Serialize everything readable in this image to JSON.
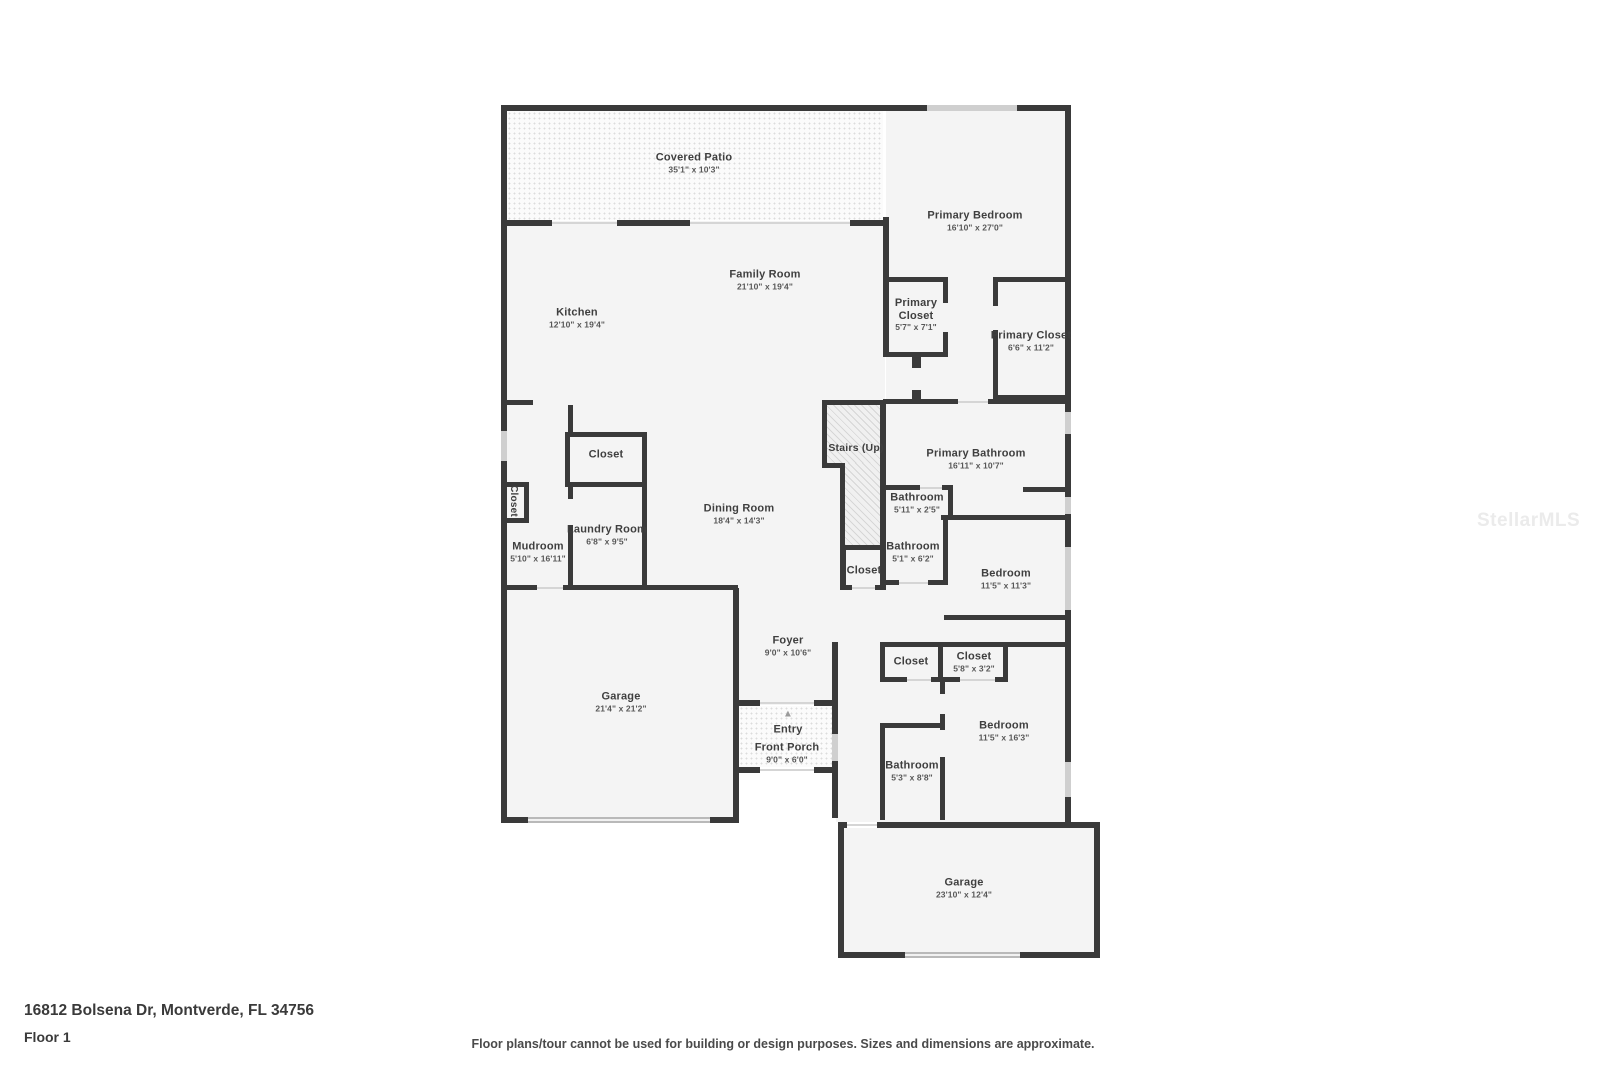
{
  "rooms": {
    "covered_patio": {
      "name": "Covered Patio",
      "dims": "35'1\" x 10'3\""
    },
    "family_room": {
      "name": "Family Room",
      "dims": "21'10\" x 19'4\""
    },
    "kitchen": {
      "name": "Kitchen",
      "dims": "12'10\" x 19'4\""
    },
    "primary_bedroom": {
      "name": "Primary Bedroom",
      "dims": "16'10\" x 27'0\""
    },
    "primary_closet_1": {
      "name": "Primary Closet",
      "dims": "5'7\" x 7'1\""
    },
    "primary_closet_2": {
      "name": "Primary Closet",
      "dims": "6'6\" x 11'2\""
    },
    "stairs": {
      "name": "Stairs (Up)"
    },
    "primary_bathroom": {
      "name": "Primary Bathroom",
      "dims": "16'11\" x 10'7\""
    },
    "bathroom_1": {
      "name": "Bathroom",
      "dims": "5'11\" x 2'5\""
    },
    "bathroom_2": {
      "name": "Bathroom",
      "dims": "5'1\" x 6'2\""
    },
    "closet_mid": {
      "name": "Closet"
    },
    "bedroom_1": {
      "name": "Bedroom",
      "dims": "11'5\" x 11'3\""
    },
    "dining_room": {
      "name": "Dining Room",
      "dims": "18'4\" x 14'3\""
    },
    "closet_dining": {
      "name": "Closet"
    },
    "laundry_room": {
      "name": "Laundry Room",
      "dims": "6'8\" x 9'5\""
    },
    "mudroom": {
      "name": "Mudroom",
      "dims": "5'10\" x 16'11\""
    },
    "closet_nook": {
      "name": "Closet"
    },
    "garage_1": {
      "name": "Garage",
      "dims": "21'4\" x 21'2\""
    },
    "foyer": {
      "name": "Foyer",
      "dims": "9'0\" x 10'6\""
    },
    "entry": {
      "name": "Entry"
    },
    "front_porch": {
      "name": "Front Porch",
      "dims": "9'0\" x 6'0\""
    },
    "closet_3": {
      "name": "Closet"
    },
    "closet_4": {
      "name": "Closet",
      "dims": "5'8\" x 3'2\""
    },
    "bedroom_2": {
      "name": "Bedroom",
      "dims": "11'5\" x 16'3\""
    },
    "bathroom_3": {
      "name": "Bathroom",
      "dims": "5'3\" x 8'8\""
    },
    "garage_2": {
      "name": "Garage",
      "dims": "23'10\" x 12'4\""
    }
  },
  "footer": {
    "address": "16812 Bolsena Dr, Montverde, FL 34756",
    "floor_label": "Floor 1",
    "disclaimer": "Floor plans/tour cannot be used for building or design purposes. Sizes and dimensions are approximate."
  },
  "watermark": "StellarMLS",
  "colors": {
    "wall": "#3a3a3a",
    "room_fill": "#f4f4f4",
    "window": "#cfcfcf",
    "label_text": "#3f3f3f",
    "dims_text": "#575757"
  }
}
